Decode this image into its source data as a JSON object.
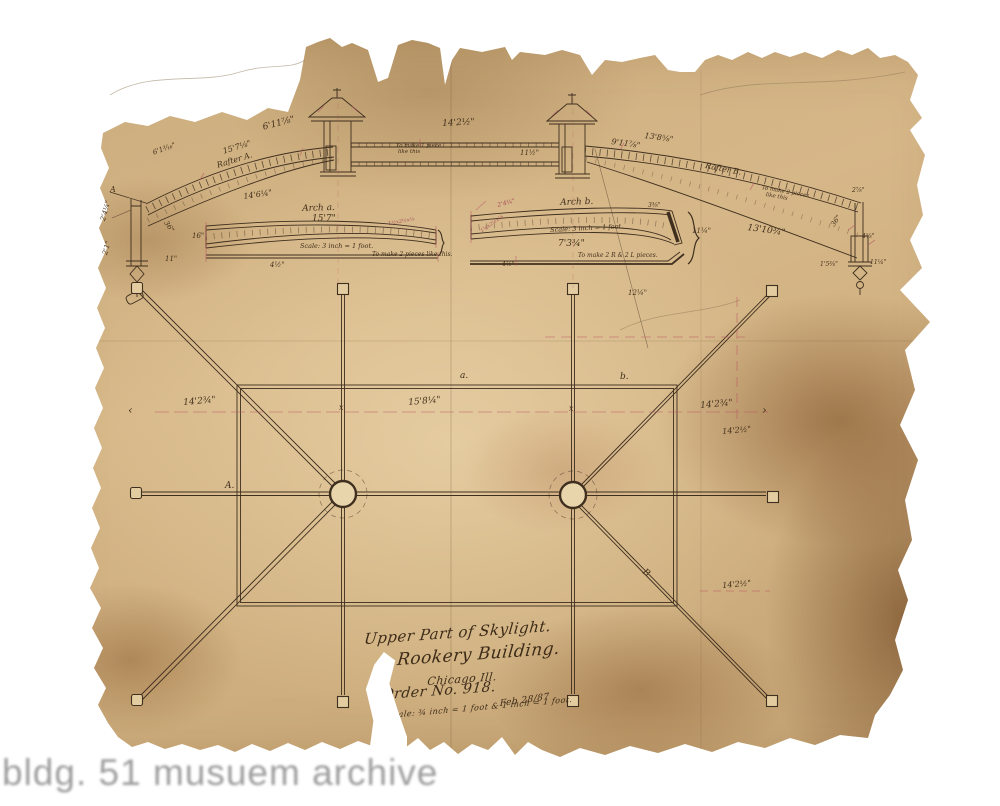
{
  "watermark": "bldg. 51 musuem archive",
  "title_block": {
    "line1": "Upper Part of Skylight.",
    "line2": "Rookery Building.",
    "line3": "Chicago Ill.",
    "order": "Order No. 918.",
    "date": "Feb 28/87",
    "scale": "Scale: ¾ inch = 1 foot & 1 inch = 1 foot."
  },
  "elevation": {
    "dim_6_1": "6'1³⁄₁₆\"",
    "dim_15_7": "15'7⅛\"",
    "rafter_a": "Rafter A.",
    "dim_6_11": "6'11⅞\"",
    "dim_14_6": "14'6¼\"",
    "dim_14_2": "14'2½\"",
    "note_center_1": "To make 1 piece",
    "note_center_2": "like this",
    "dim_11_5": "11½\"",
    "dim_9_11": "9'11⅞\"",
    "dim_13_8": "13'8⅝\"",
    "rafter_b": "Rafter B.",
    "note_right_1": "To make 2 pieces",
    "note_right_2": "like this",
    "dim_13_10": "13'10¾\"",
    "dim_12_25": "12¼\"",
    "left_post": {
      "d1": "2'4¼\"",
      "d2": "2'1\"",
      "d3": "36\"",
      "d4": "11\"",
      "marker": "A"
    },
    "right_post": {
      "d1": "36\"",
      "d2": "4⅝\"",
      "d3": "1'5⅜\"",
      "d4": "11¼\"",
      "d5": "2⅞\""
    }
  },
  "arch_a": {
    "title": "Arch a.",
    "dim": "15'7\"",
    "left_dim": "16\"",
    "scale": "Scale: 3 inch = 1 foot.",
    "note": "To make 2 pieces like this.",
    "angle": "1½x2½x⅛",
    "bottom_dim": "4½\""
  },
  "arch_b": {
    "title": "Arch b.",
    "scale": "Scale: 3 inch = 1 foot.",
    "dim": "7'3¾\"",
    "note": "To make 2 R & 2 L pieces.",
    "angle": "1¾x2½x⅛",
    "right_dim": "11¼\"",
    "top_right_dim": "3⅜\"",
    "top_left_dim": "2'4¾\"",
    "bottom_dim": "4½\""
  },
  "plan": {
    "label_a": "a.",
    "label_b": "b.",
    "label_A": "A.",
    "label_B": "B",
    "mark_x1": "x",
    "mark_x2": "x",
    "dim_left": "14'2¾\"",
    "dim_center": "15'8¼\"",
    "dim_right": "14'2¾\"",
    "dim_right_2": "14'2½\"",
    "dim_right_3": "14'2½\"",
    "arrow_right": "›",
    "arrow_left": "‹"
  }
}
